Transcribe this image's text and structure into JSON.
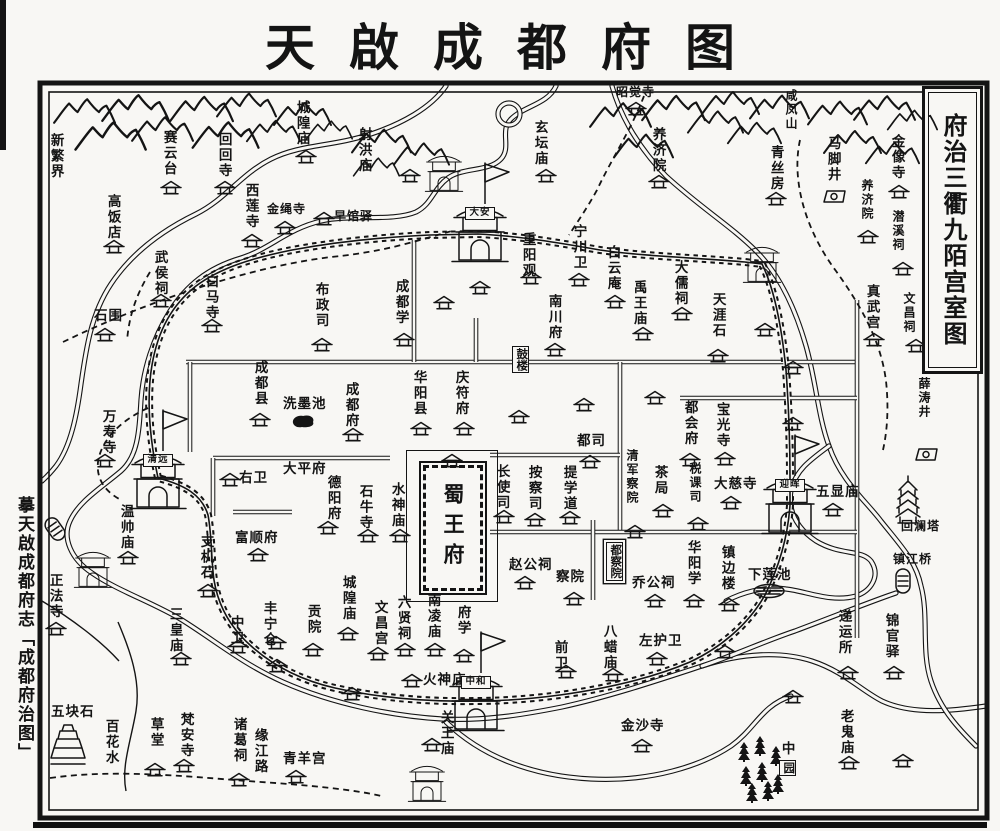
{
  "title": "天啟成都府图",
  "side_caption": "摹天啟成都府志「成都府治图」",
  "legend_box": "府治三衢九陌宫室图",
  "palace": {
    "name": "蜀王府"
  },
  "colors": {
    "ink": "#141414",
    "paper": "#f8f7f4"
  },
  "gates": [
    {
      "n": "大安",
      "x": 480,
      "y": 234
    },
    {
      "n": "清远",
      "x": 158,
      "y": 481
    },
    {
      "n": "迎晖",
      "x": 790,
      "y": 506
    },
    {
      "n": "中和",
      "x": 476,
      "y": 703
    }
  ],
  "towers": [
    [
      444,
      173
    ],
    [
      762,
      264
    ],
    [
      93,
      569
    ],
    [
      427,
      783
    ]
  ],
  "labels": [
    {
      "t": "新繁界",
      "x": 57,
      "y": 133,
      "o": "v"
    },
    {
      "t": "赛云台",
      "x": 170,
      "y": 130,
      "o": "v"
    },
    {
      "t": "回回寺",
      "x": 225,
      "y": 132,
      "o": "v"
    },
    {
      "t": "城隍庙",
      "x": 303,
      "y": 100,
      "o": "v"
    },
    {
      "t": "射洪庙",
      "x": 365,
      "y": 127,
      "o": "v"
    },
    {
      "t": "玄坛庙",
      "x": 541,
      "y": 120,
      "o": "v"
    },
    {
      "t": "昭觉寺",
      "x": 616,
      "y": 86,
      "o": "h",
      "s": 12
    },
    {
      "t": "咸凤山",
      "x": 793,
      "y": 89,
      "o": "v",
      "s": 12
    },
    {
      "t": "养济院",
      "x": 659,
      "y": 127,
      "o": "v"
    },
    {
      "t": "青丝房",
      "x": 777,
      "y": 145,
      "o": "v"
    },
    {
      "t": "马脚井",
      "x": 834,
      "y": 136,
      "o": "v"
    },
    {
      "t": "金像寺",
      "x": 898,
      "y": 134,
      "o": "v"
    },
    {
      "t": "养济院",
      "x": 869,
      "y": 179,
      "o": "v",
      "s": 12
    },
    {
      "t": "潜溪祠",
      "x": 900,
      "y": 210,
      "o": "v",
      "s": 12
    },
    {
      "t": "真武宫",
      "x": 873,
      "y": 284,
      "o": "v"
    },
    {
      "t": "文昌祠",
      "x": 911,
      "y": 292,
      "o": "v",
      "s": 12
    },
    {
      "t": "薛涛井",
      "x": 926,
      "y": 377,
      "o": "v",
      "s": 12
    },
    {
      "t": "高饭店",
      "x": 114,
      "y": 194,
      "o": "v"
    },
    {
      "t": "西莲寺",
      "x": 252,
      "y": 183,
      "o": "v"
    },
    {
      "t": "金绳寺",
      "x": 267,
      "y": 203,
      "o": "h",
      "s": 12
    },
    {
      "t": "早馆驿",
      "x": 334,
      "y": 210,
      "o": "h",
      "s": 12
    },
    {
      "t": "武侯祠",
      "x": 161,
      "y": 250,
      "o": "v"
    },
    {
      "t": "白马寺",
      "x": 212,
      "y": 274,
      "o": "v"
    },
    {
      "t": "石围",
      "x": 94,
      "y": 309,
      "o": "h"
    },
    {
      "t": "布政司",
      "x": 322,
      "y": 282,
      "o": "v"
    },
    {
      "t": "成都学",
      "x": 402,
      "y": 279,
      "o": "v"
    },
    {
      "t": "宁川卫",
      "x": 580,
      "y": 224,
      "o": "v"
    },
    {
      "t": "重阳观",
      "x": 529,
      "y": 232,
      "o": "v"
    },
    {
      "t": "白云庵",
      "x": 614,
      "y": 245,
      "o": "v"
    },
    {
      "t": "禹王庙",
      "x": 640,
      "y": 280,
      "o": "v"
    },
    {
      "t": "大儒祠",
      "x": 681,
      "y": 260,
      "o": "v"
    },
    {
      "t": "南川府",
      "x": 555,
      "y": 294,
      "o": "v"
    },
    {
      "t": "天涯石",
      "x": 719,
      "y": 292,
      "o": "v"
    },
    {
      "t": "成都县",
      "x": 261,
      "y": 360,
      "o": "v"
    },
    {
      "t": "洗墨池",
      "x": 283,
      "y": 397,
      "o": "h"
    },
    {
      "t": "成都府",
      "x": 352,
      "y": 382,
      "o": "v"
    },
    {
      "t": "华阳县",
      "x": 420,
      "y": 370,
      "o": "v"
    },
    {
      "t": "庆符府",
      "x": 462,
      "y": 370,
      "o": "v"
    },
    {
      "t": "万寿寺",
      "x": 109,
      "y": 409,
      "o": "v"
    },
    {
      "t": "大平府",
      "x": 283,
      "y": 462,
      "o": "h"
    },
    {
      "t": "右卫",
      "x": 239,
      "y": 471,
      "o": "h"
    },
    {
      "t": "德阳府",
      "x": 334,
      "y": 475,
      "o": "v"
    },
    {
      "t": "石牛寺",
      "x": 366,
      "y": 484,
      "o": "v"
    },
    {
      "t": "水神庙",
      "x": 398,
      "y": 482,
      "o": "v"
    },
    {
      "t": "都司",
      "x": 577,
      "y": 434,
      "o": "h"
    },
    {
      "t": "长使司",
      "x": 503,
      "y": 464,
      "o": "v"
    },
    {
      "t": "按察司",
      "x": 535,
      "y": 465,
      "o": "v"
    },
    {
      "t": "提学道",
      "x": 570,
      "y": 465,
      "o": "v"
    },
    {
      "t": "清军察院",
      "x": 634,
      "y": 449,
      "o": "v",
      "s": 12
    },
    {
      "t": "茶局",
      "x": 661,
      "y": 465,
      "o": "v"
    },
    {
      "t": "都会府",
      "x": 691,
      "y": 400,
      "o": "v"
    },
    {
      "t": "宝光寺",
      "x": 723,
      "y": 402,
      "o": "v"
    },
    {
      "t": "税课司",
      "x": 697,
      "y": 462,
      "o": "v",
      "s": 12
    },
    {
      "t": "大慈寺",
      "x": 714,
      "y": 477,
      "o": "h"
    },
    {
      "t": "五显庙",
      "x": 816,
      "y": 485,
      "o": "h"
    },
    {
      "t": "回澜塔",
      "x": 901,
      "y": 520,
      "o": "h",
      "s": 12
    },
    {
      "t": "镇江桥",
      "x": 893,
      "y": 553,
      "o": "h",
      "s": 12
    },
    {
      "t": "下莲池",
      "x": 748,
      "y": 568,
      "o": "h"
    },
    {
      "t": "镇边楼",
      "x": 728,
      "y": 545,
      "o": "v"
    },
    {
      "t": "华阳学",
      "x": 694,
      "y": 540,
      "o": "v"
    },
    {
      "t": "乔公祠",
      "x": 632,
      "y": 576,
      "o": "h"
    },
    {
      "t": "察院",
      "x": 556,
      "y": 570,
      "o": "h"
    },
    {
      "t": "赵公祠",
      "x": 509,
      "y": 558,
      "o": "h"
    },
    {
      "t": "八蜡庙",
      "x": 610,
      "y": 624,
      "o": "v"
    },
    {
      "t": "左护卫",
      "x": 639,
      "y": 634,
      "o": "h"
    },
    {
      "t": "前卫",
      "x": 561,
      "y": 640,
      "o": "v"
    },
    {
      "t": "金沙寺",
      "x": 621,
      "y": 719,
      "o": "h"
    },
    {
      "t": "老鬼庙",
      "x": 847,
      "y": 709,
      "o": "v"
    },
    {
      "t": "递运所",
      "x": 845,
      "y": 609,
      "o": "v"
    },
    {
      "t": "锦官驿",
      "x": 892,
      "y": 613,
      "o": "v"
    },
    {
      "t": "中",
      "x": 788,
      "y": 741,
      "o": "v"
    },
    {
      "t": "五块石",
      "x": 51,
      "y": 705,
      "o": "h"
    },
    {
      "t": "百花水",
      "x": 112,
      "y": 719,
      "o": "v"
    },
    {
      "t": "草堂",
      "x": 157,
      "y": 717,
      "o": "v"
    },
    {
      "t": "梵安寺",
      "x": 187,
      "y": 712,
      "o": "v"
    },
    {
      "t": "诸葛祠",
      "x": 240,
      "y": 717,
      "o": "v"
    },
    {
      "t": "缘江路",
      "x": 261,
      "y": 728,
      "o": "v"
    },
    {
      "t": "青羊宫",
      "x": 283,
      "y": 752,
      "o": "h"
    },
    {
      "t": "三皇庙",
      "x": 176,
      "y": 607,
      "o": "v"
    },
    {
      "t": "正法寺",
      "x": 56,
      "y": 573,
      "o": "v"
    },
    {
      "t": "温帅庙",
      "x": 127,
      "y": 504,
      "o": "v"
    },
    {
      "t": "支机石",
      "x": 207,
      "y": 534,
      "o": "v"
    },
    {
      "t": "富顺府",
      "x": 235,
      "y": 531,
      "o": "h"
    },
    {
      "t": "中卫",
      "x": 237,
      "y": 615,
      "o": "v"
    },
    {
      "t": "丰宁仓",
      "x": 270,
      "y": 601,
      "o": "v"
    },
    {
      "t": "贡院",
      "x": 314,
      "y": 604,
      "o": "v"
    },
    {
      "t": "城隍庙",
      "x": 349,
      "y": 575,
      "o": "v"
    },
    {
      "t": "文昌宫",
      "x": 381,
      "y": 600,
      "o": "v"
    },
    {
      "t": "六贤祠",
      "x": 404,
      "y": 595,
      "o": "v"
    },
    {
      "t": "南凌庙",
      "x": 434,
      "y": 593,
      "o": "v"
    },
    {
      "t": "府学",
      "x": 464,
      "y": 605,
      "o": "v"
    },
    {
      "t": "火神庙",
      "x": 423,
      "y": 673,
      "o": "h"
    },
    {
      "t": "关王庙",
      "x": 447,
      "y": 710,
      "o": "v"
    }
  ],
  "boxed_labels": [
    {
      "t": "鼓楼",
      "x": 521,
      "y": 346,
      "o": "v"
    },
    {
      "t": "都察院",
      "x": 615,
      "y": 542,
      "o": "v",
      "d": true
    },
    {
      "t": "园",
      "x": 788,
      "y": 760,
      "o": "v"
    }
  ],
  "halls": [
    [
      306,
      157
    ],
    [
      171,
      188
    ],
    [
      225,
      188
    ],
    [
      410,
      176
    ],
    [
      546,
      176
    ],
    [
      636,
      109
    ],
    [
      659,
      182
    ],
    [
      776,
      199
    ],
    [
      899,
      192
    ],
    [
      868,
      237
    ],
    [
      903,
      269
    ],
    [
      874,
      340
    ],
    [
      916,
      346
    ],
    [
      114,
      247
    ],
    [
      252,
      241
    ],
    [
      285,
      228
    ],
    [
      324,
      219
    ],
    [
      161,
      301
    ],
    [
      212,
      326
    ],
    [
      105,
      335
    ],
    [
      322,
      345
    ],
    [
      404,
      340
    ],
    [
      579,
      280
    ],
    [
      531,
      278
    ],
    [
      615,
      302
    ],
    [
      643,
      334
    ],
    [
      682,
      314
    ],
    [
      555,
      350
    ],
    [
      718,
      356
    ],
    [
      353,
      435
    ],
    [
      421,
      429
    ],
    [
      464,
      429
    ],
    [
      260,
      420
    ],
    [
      105,
      461
    ],
    [
      590,
      462
    ],
    [
      504,
      517
    ],
    [
      535,
      520
    ],
    [
      570,
      518
    ],
    [
      635,
      532
    ],
    [
      663,
      511
    ],
    [
      690,
      460
    ],
    [
      725,
      459
    ],
    [
      698,
      524
    ],
    [
      731,
      503
    ],
    [
      833,
      510
    ],
    [
      729,
      605
    ],
    [
      694,
      601
    ],
    [
      655,
      601
    ],
    [
      574,
      599
    ],
    [
      525,
      583
    ],
    [
      613,
      675
    ],
    [
      657,
      659
    ],
    [
      566,
      672
    ],
    [
      642,
      746
    ],
    [
      849,
      763
    ],
    [
      848,
      673
    ],
    [
      894,
      673
    ],
    [
      155,
      770
    ],
    [
      184,
      766
    ],
    [
      239,
      780
    ],
    [
      296,
      777
    ],
    [
      181,
      659
    ],
    [
      56,
      629
    ],
    [
      128,
      558
    ],
    [
      208,
      591
    ],
    [
      258,
      555
    ],
    [
      230,
      480
    ],
    [
      238,
      647
    ],
    [
      276,
      643
    ],
    [
      313,
      650
    ],
    [
      348,
      634
    ],
    [
      378,
      654
    ],
    [
      405,
      650
    ],
    [
      435,
      650
    ],
    [
      464,
      656
    ],
    [
      412,
      681
    ],
    [
      432,
      745
    ],
    [
      328,
      528
    ],
    [
      368,
      536
    ],
    [
      400,
      536
    ],
    [
      452,
      461
    ],
    [
      480,
      288
    ],
    [
      444,
      303
    ],
    [
      519,
      417
    ],
    [
      584,
      405
    ],
    [
      765,
      330
    ],
    [
      793,
      368
    ],
    [
      655,
      398
    ],
    [
      352,
      694
    ],
    [
      277,
      666
    ],
    [
      793,
      697
    ],
    [
      903,
      761
    ],
    [
      793,
      424
    ],
    [
      725,
      652
    ]
  ],
  "wells": [
    [
      835,
      197
    ],
    [
      927,
      455
    ]
  ],
  "pond_blob": [
    [
      303,
      421
    ]
  ],
  "pond_lotus": [
    [
      769,
      591
    ]
  ],
  "bridges": [
    {
      "x": 903,
      "y": 581,
      "r": 0
    },
    {
      "x": 55,
      "y": 529,
      "r": -35
    }
  ],
  "pagodas": [
    [
      908,
      500
    ]
  ],
  "stones": [
    [
      68,
      744
    ]
  ],
  "pines": [
    [
      744,
      752
    ],
    [
      760,
      746
    ],
    [
      776,
      756
    ],
    [
      746,
      776
    ],
    [
      762,
      772
    ],
    [
      778,
      784
    ],
    [
      752,
      793
    ],
    [
      768,
      791
    ]
  ],
  "mountains": [
    [
      52,
      96,
      64,
      30
    ],
    [
      100,
      92,
      70,
      32
    ],
    [
      70,
      120,
      80,
      32
    ],
    [
      130,
      115,
      64,
      28
    ],
    [
      168,
      94,
      66,
      30
    ],
    [
      215,
      90,
      62,
      30
    ],
    [
      188,
      120,
      74,
      30
    ],
    [
      245,
      118,
      56,
      26
    ],
    [
      272,
      100,
      60,
      28
    ],
    [
      305,
      118,
      48,
      24
    ],
    [
      350,
      126,
      62,
      30
    ],
    [
      392,
      140,
      58,
      28
    ],
    [
      352,
      155,
      48,
      24
    ],
    [
      588,
      100,
      64,
      30
    ],
    [
      640,
      92,
      66,
      32
    ],
    [
      686,
      108,
      58,
      28
    ],
    [
      612,
      132,
      62,
      28
    ],
    [
      700,
      88,
      60,
      30
    ],
    [
      748,
      92,
      62,
      30
    ],
    [
      726,
      120,
      56,
      26
    ],
    [
      806,
      98,
      62,
      30
    ],
    [
      852,
      92,
      64,
      32
    ],
    [
      886,
      106,
      52,
      28
    ],
    [
      822,
      128,
      60,
      28
    ],
    [
      864,
      140,
      56,
      26
    ]
  ]
}
